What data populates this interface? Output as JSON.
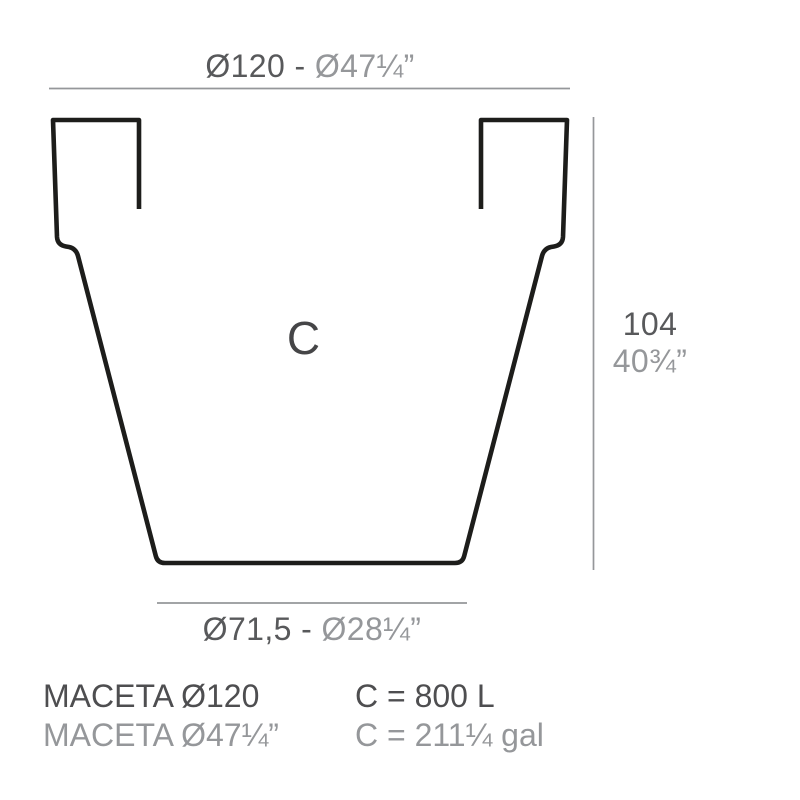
{
  "drawing": {
    "content_letter": "C",
    "top_dimension": {
      "metric": "Ø120 - ",
      "imperial": "Ø47¼”"
    },
    "bottom_dimension": {
      "metric": "Ø71,5 - ",
      "imperial": "Ø28¼”"
    },
    "height_dimension": {
      "metric": "104",
      "imperial": "40¾”"
    }
  },
  "caption": {
    "product_name_metric": "MACETA Ø120",
    "product_name_imperial": "MACETA Ø47¼”",
    "capacity_liters": "C = 800 L",
    "capacity_gallons": "C = 211¼ gal"
  },
  "colors": {
    "outline": "#1d1d1b",
    "dimension_line": "#95979a",
    "text_dark": "#58595b",
    "text_light": "#95979a",
    "background": "#ffffff"
  }
}
